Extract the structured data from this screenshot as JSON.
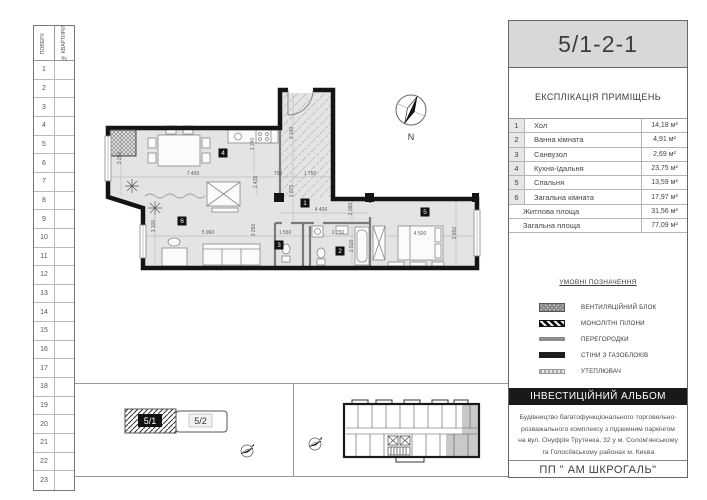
{
  "title_block": {
    "code": "5/1-2-1"
  },
  "floors_table": {
    "col1_header": "ПОВЕРХ",
    "col2_header": "№ КВАРТИРИ",
    "floors": [
      "1",
      "2",
      "3",
      "4",
      "5",
      "6",
      "7",
      "8",
      "9",
      "10",
      "11",
      "12",
      "13",
      "14",
      "15",
      "16",
      "17",
      "18",
      "19",
      "20",
      "21",
      "22",
      "23"
    ]
  },
  "explication": {
    "title": "ЕКСПЛІКАЦІЯ ПРИМІЩЕНЬ",
    "rooms": [
      {
        "num": "1",
        "name": "Хол",
        "area": "14,18 м²"
      },
      {
        "num": "2",
        "name": "Ванна кімната",
        "area": "4,91 м²"
      },
      {
        "num": "3",
        "name": "Санвузол",
        "area": "2,69 м²"
      },
      {
        "num": "4",
        "name": "Кухня-їдальня",
        "area": "23,75 м²"
      },
      {
        "num": "5",
        "name": "Спальня",
        "area": "13,59 м²"
      },
      {
        "num": "6",
        "name": "Загальна кімната",
        "area": "17,97 м²"
      }
    ],
    "totals": [
      {
        "name": "Житлова площа",
        "area": "31,56 м²"
      },
      {
        "name": "Загальна площа",
        "area": "77,09 м²"
      }
    ]
  },
  "legend": {
    "title": "УМОВНІ ПОЗНАЧЕННЯ",
    "items": [
      {
        "label": "ВЕНТИЛЯЦІЙНИЙ БЛОК",
        "type": "vent"
      },
      {
        "label": "МОНОЛІТНІ ПІЛОНИ",
        "type": "pilon"
      },
      {
        "label": "ПЕРЕГОРОДКИ",
        "type": "partition"
      },
      {
        "label": "СТІНИ З ГАЗОБЛОКІВ",
        "type": "gasblock"
      },
      {
        "label": "УТЕПЛЮВАЧ",
        "type": "insulation"
      }
    ]
  },
  "footer": {
    "album": "ІНВЕСТИЦІЙНИЙ АЛЬБОМ",
    "address": "Будівництво багатофункціонального торговельно-розважального комплексу з підземним паркінгом на вул. Онуфрія Трутенка, 32 у м. Солом'янському та Голосіївському районах м. Києва",
    "company": "ПП \" АМ ШКРОГАЛЬ\""
  },
  "site_key": {
    "blocks": [
      {
        "label": "5/1",
        "highlighted": true
      },
      {
        "label": "5/2",
        "highlighted": false
      }
    ]
  },
  "compass": {
    "label": "N"
  },
  "plan": {
    "room_badges": [
      {
        "n": "1",
        "x": 217,
        "y": 125
      },
      {
        "n": "2",
        "x": 252,
        "y": 173
      },
      {
        "n": "3",
        "x": 191,
        "y": 167
      },
      {
        "n": "4",
        "x": 135,
        "y": 75
      },
      {
        "n": "5",
        "x": 337,
        "y": 134
      },
      {
        "n": "6",
        "x": 94,
        "y": 143
      }
    ],
    "dimensions": [
      {
        "text": "7 400",
        "x": 105,
        "y": 97,
        "r": 0
      },
      {
        "text": "3 250",
        "x": 33,
        "y": 80,
        "r": -90
      },
      {
        "text": "1 740",
        "x": 166,
        "y": 66,
        "r": -90
      },
      {
        "text": "1 435",
        "x": 169,
        "y": 104,
        "r": -90
      },
      {
        "text": "3 140",
        "x": 205,
        "y": 55,
        "r": -90
      },
      {
        "text": "700",
        "x": 190,
        "y": 97,
        "r": 0
      },
      {
        "text": "1 750",
        "x": 222,
        "y": 97,
        "r": 0
      },
      {
        "text": "2 675",
        "x": 205,
        "y": 113,
        "r": -90
      },
      {
        "text": "4 400",
        "x": 233,
        "y": 133,
        "r": 0
      },
      {
        "text": "2 090",
        "x": 264,
        "y": 131,
        "r": -90
      },
      {
        "text": "3 100",
        "x": 67,
        "y": 148,
        "r": -90
      },
      {
        "text": "5 960",
        "x": 120,
        "y": 156,
        "r": 0
      },
      {
        "text": "3 250",
        "x": 167,
        "y": 152,
        "r": -90
      },
      {
        "text": "1 550",
        "x": 197,
        "y": 156,
        "r": 0
      },
      {
        "text": "2 750",
        "x": 250,
        "y": 156,
        "r": 0
      },
      {
        "text": "1 910",
        "x": 265,
        "y": 168,
        "r": -90
      },
      {
        "text": "4 500",
        "x": 332,
        "y": 157,
        "r": 0
      },
      {
        "text": "2 850",
        "x": 368,
        "y": 155,
        "r": -90
      }
    ]
  },
  "colors": {
    "title_bg": "#d8d8d8",
    "wall": "#141414",
    "room_fill": "#e4e4e4",
    "highlight_unit": "#c9c9c9",
    "album_bar_bg": "#191919"
  }
}
